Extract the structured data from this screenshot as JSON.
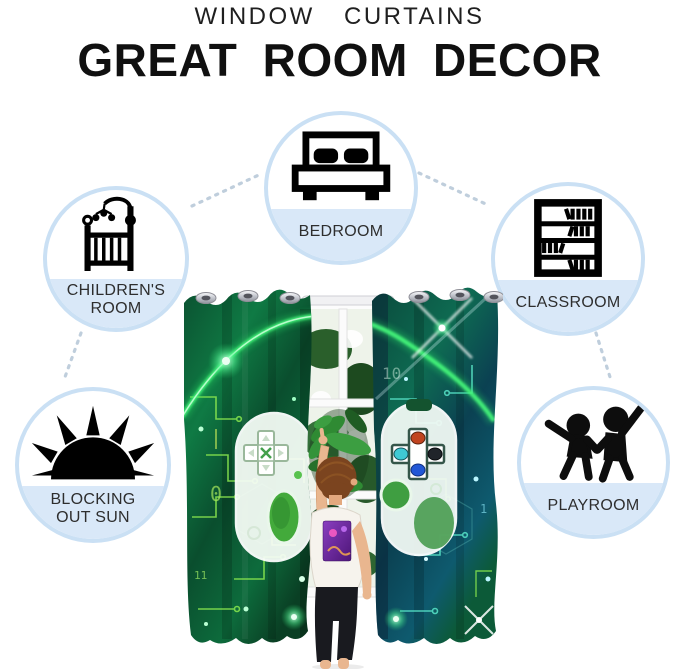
{
  "header": {
    "line1": "WINDOW CURTAINS",
    "line2": "GREAT ROOM DECOR"
  },
  "badges": [
    {
      "id": "childrens-room",
      "label": "CHILDREN'S ROOM",
      "icon": "crib-icon"
    },
    {
      "id": "bedroom",
      "label": "BEDROOM",
      "icon": "bed-icon"
    },
    {
      "id": "classroom",
      "label": "CLASSROOM",
      "icon": "bookshelf-icon"
    },
    {
      "id": "blocking-out-sun",
      "label": "BLOCKING OUT SUN",
      "icon": "sun-icon"
    },
    {
      "id": "playroom",
      "label": "PLAYROOM",
      "icon": "children-playing-icon"
    }
  ],
  "product_image": {
    "alt": "Two green gamer game-controller print blackout curtain panels with silver grommets on a white rod over a window; a child reaches up between the panels",
    "texture_digits": [
      "0",
      "1",
      "10",
      "11"
    ]
  },
  "colors": {
    "badge_ring": "#cae0f4",
    "badge_chord": "#d9e8f8",
    "badge_label": "#2e2e2e",
    "connector_dots": "#b9c9d9",
    "title": "#101010",
    "curtain_green": "#0f7a44",
    "curtain_teal": "#0c4a56",
    "glow_green": "#45f57a"
  }
}
